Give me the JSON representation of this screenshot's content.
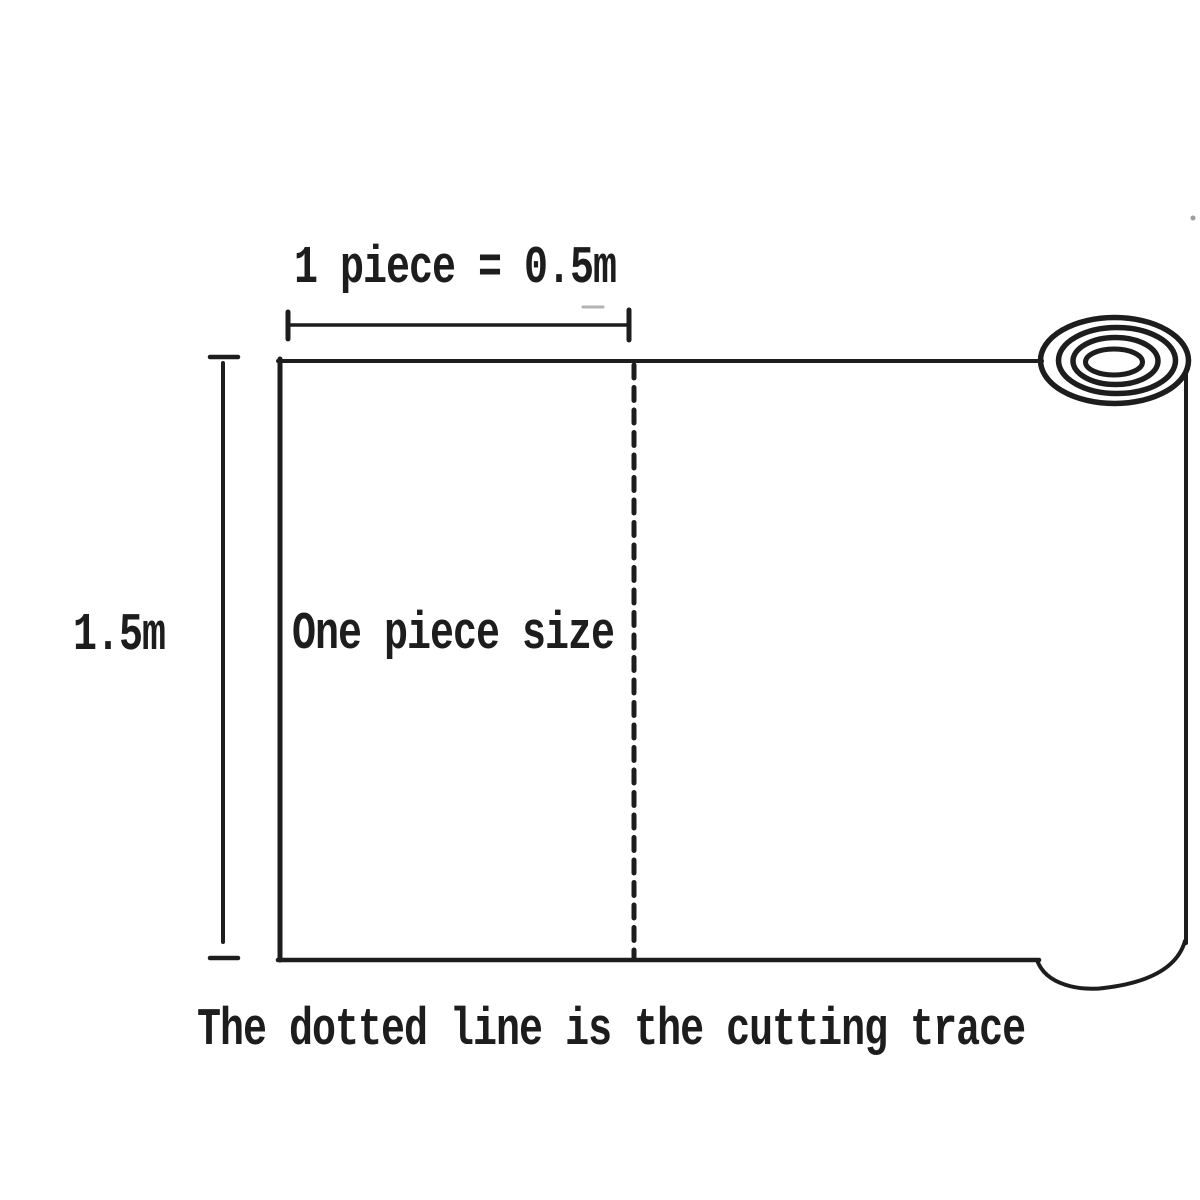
{
  "diagram": {
    "top_dimension_label": "1 piece = 0.5m",
    "left_dimension_label": "1.5m",
    "sheet_label": "One piece size",
    "caption": "The dotted line is the cutting trace",
    "colors": {
      "background": "#ffffff",
      "ink": "#1d1d1d"
    }
  }
}
